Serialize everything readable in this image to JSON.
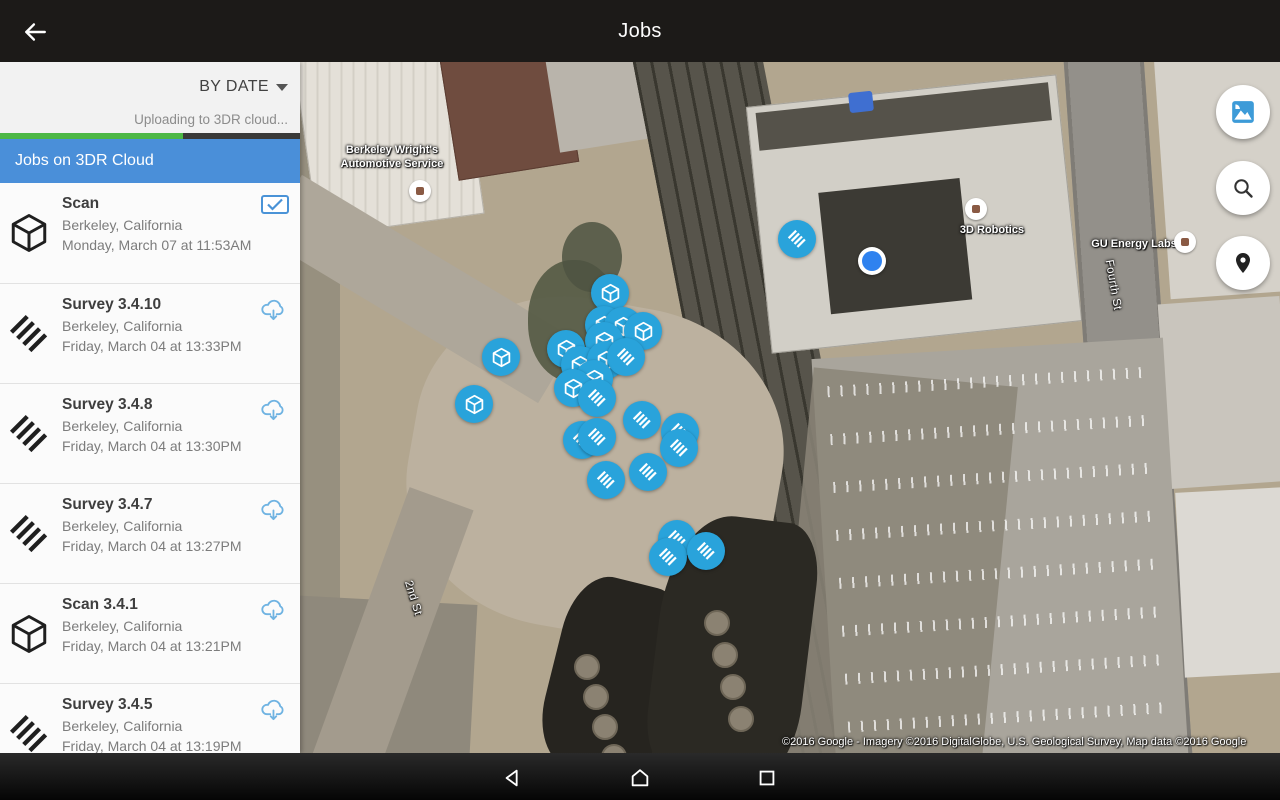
{
  "topbar": {
    "title": "Jobs",
    "back_icon": "arrow-left-icon"
  },
  "navbar": {
    "back_icon": "back-triangle-icon",
    "home_icon": "home-icon",
    "recents_icon": "recents-square-icon"
  },
  "sidebar": {
    "sort_label": "BY DATE",
    "sort_icon": "dropdown-triangle-icon",
    "upload_status": "Uploading to 3DR cloud...",
    "upload_progress_percent": 61,
    "banner": "Jobs on 3DR Cloud",
    "jobs": [
      {
        "type": "scan",
        "title": "Scan",
        "location": "Berkeley, California",
        "date": "Monday, March 07 at 11:53AM",
        "action": "selected-checkbox"
      },
      {
        "type": "survey",
        "title": "Survey 3.4.10",
        "location": "Berkeley, California",
        "date": "Friday, March 04 at 13:33PM",
        "action": "cloud-download"
      },
      {
        "type": "survey",
        "title": "Survey 3.4.8",
        "location": "Berkeley, California",
        "date": "Friday, March 04 at 13:30PM",
        "action": "cloud-download"
      },
      {
        "type": "survey",
        "title": "Survey 3.4.7",
        "location": "Berkeley, California",
        "date": "Friday, March 04 at 13:27PM",
        "action": "cloud-download"
      },
      {
        "type": "scan",
        "title": "Scan 3.4.1",
        "location": "Berkeley, California",
        "date": "Friday, March 04 at 13:21PM",
        "action": "cloud-download"
      },
      {
        "type": "survey",
        "title": "Survey 3.4.5",
        "location": "Berkeley, California",
        "date": "Friday, March 04 at 13:19PM",
        "action": "cloud-download"
      }
    ]
  },
  "map": {
    "labels": {
      "business_1_line1": "Berkeley Wright's",
      "business_1_line2": "Automotive Service",
      "business_2": "3D Robotics",
      "business_3": "GU Energy Labs",
      "street_1": "Fourth St",
      "street_2": "2nd St"
    },
    "fabs": [
      {
        "name": "map-type",
        "icon": "satellite-layer-icon"
      },
      {
        "name": "search",
        "icon": "search-icon"
      },
      {
        "name": "my-location",
        "icon": "location-pin-icon"
      }
    ],
    "attribution": "©2016 Google - Imagery ©2016 DigitalGlobe, U.S. Geological Survey, Map data ©2016 Google",
    "markers": [
      {
        "type": "survey",
        "x": 497,
        "y": 177
      },
      {
        "type": "scan",
        "x": 310,
        "y": 231
      },
      {
        "type": "scan",
        "x": 304,
        "y": 263
      },
      {
        "type": "scan",
        "x": 323,
        "y": 264
      },
      {
        "type": "scan",
        "x": 343,
        "y": 269
      },
      {
        "type": "scan",
        "x": 304,
        "y": 279
      },
      {
        "type": "scan",
        "x": 266,
        "y": 287
      },
      {
        "type": "scan",
        "x": 201,
        "y": 295
      },
      {
        "type": "scan",
        "x": 280,
        "y": 303
      },
      {
        "type": "scan",
        "x": 306,
        "y": 298
      },
      {
        "type": "survey",
        "x": 326,
        "y": 295
      },
      {
        "type": "scan",
        "x": 294,
        "y": 317
      },
      {
        "type": "scan",
        "x": 273,
        "y": 326
      },
      {
        "type": "survey",
        "x": 297,
        "y": 336
      },
      {
        "type": "scan",
        "x": 174,
        "y": 342
      },
      {
        "type": "survey",
        "x": 342,
        "y": 358
      },
      {
        "type": "survey",
        "x": 380,
        "y": 370
      },
      {
        "type": "survey",
        "x": 282,
        "y": 378
      },
      {
        "type": "survey",
        "x": 297,
        "y": 375
      },
      {
        "type": "survey",
        "x": 379,
        "y": 386
      },
      {
        "type": "survey",
        "x": 348,
        "y": 410
      },
      {
        "type": "survey",
        "x": 306,
        "y": 418
      },
      {
        "type": "survey",
        "x": 377,
        "y": 477
      },
      {
        "type": "survey",
        "x": 368,
        "y": 495
      },
      {
        "type": "survey",
        "x": 406,
        "y": 489
      }
    ]
  },
  "colors": {
    "topbar_bg": "#1c1a18",
    "banner_blue": "#4a8fd9",
    "progress_green": "#4db845",
    "marker_blue": "#29a3db",
    "accent_blue": "#4a93d7",
    "cloud_icon_blue": "#6fb3e2"
  }
}
